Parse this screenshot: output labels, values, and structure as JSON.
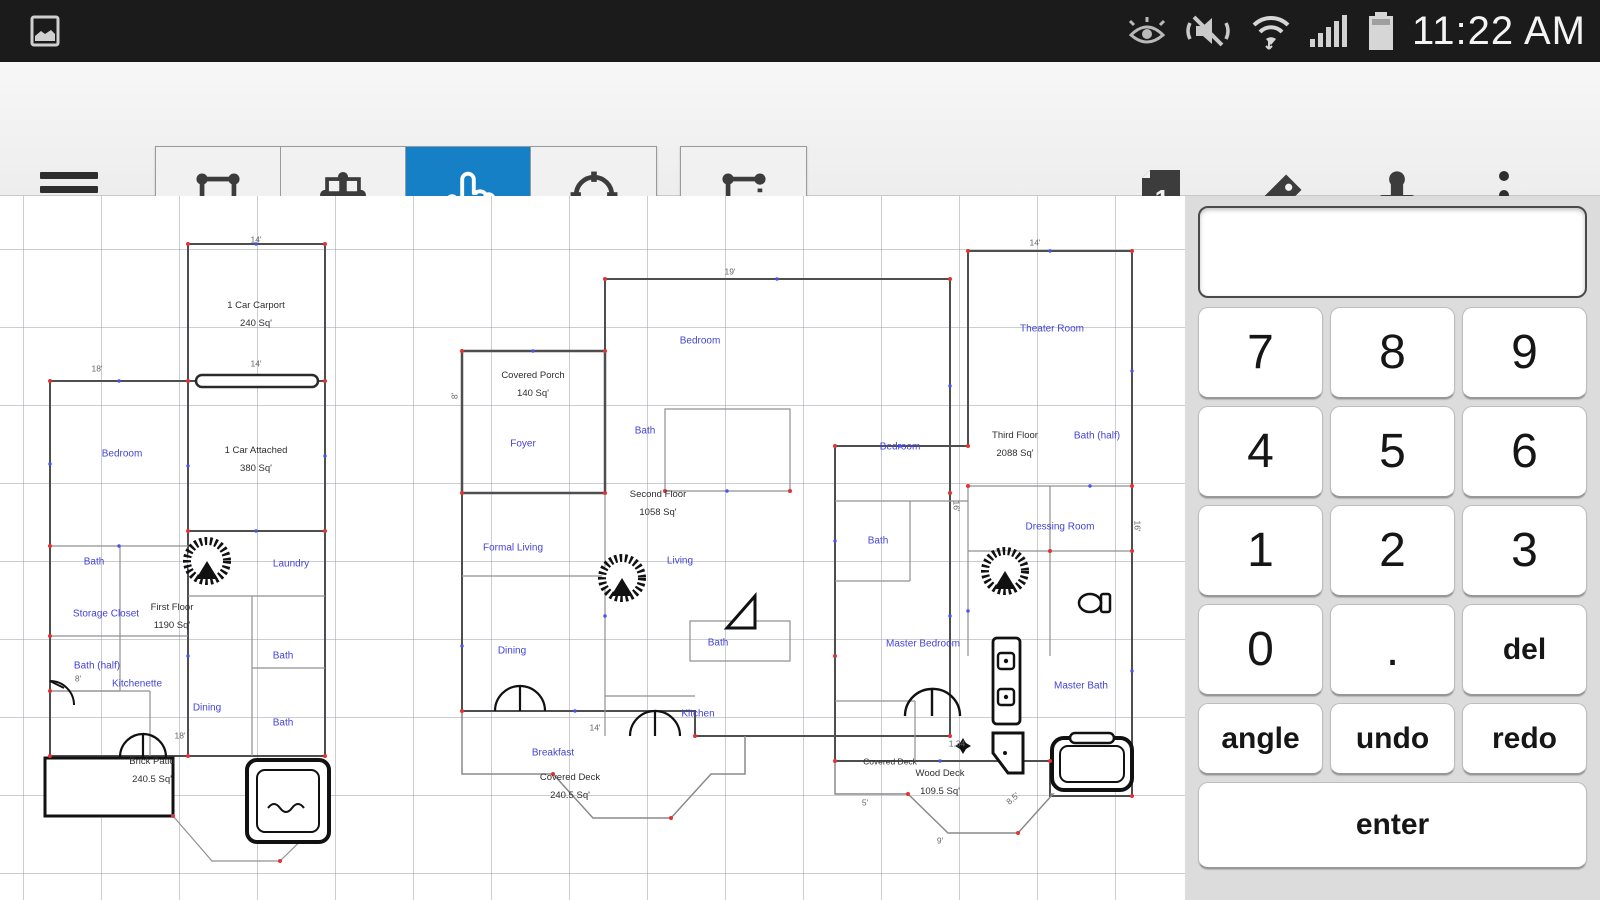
{
  "status_bar": {
    "time": "11:22 AM"
  },
  "toolbar": {
    "active_tool": "select-hand",
    "accent_color": "#1580c5",
    "page_badge": "1"
  },
  "keypad": {
    "display_value": "",
    "digits": [
      "7",
      "8",
      "9",
      "4",
      "5",
      "6",
      "1",
      "2",
      "3",
      "0",
      ".",
      "del"
    ],
    "actions": [
      "angle",
      "undo",
      "redo"
    ],
    "enter_label": "enter"
  },
  "plans": {
    "p1": {
      "rooms": [
        "Bedroom",
        "Bath",
        "Laundry",
        "Storage  Closet",
        "Bath",
        "Bath (half)",
        "Kitchenette",
        "Dining",
        "Bath"
      ],
      "areas": [
        "1 Car Carport",
        "240 Sq'",
        "1 Car Attached",
        "380 Sq'",
        "First Floor",
        "1190 Sq'",
        "Brick Patio",
        "240.5 Sq'"
      ],
      "dims": [
        "14'",
        "18'",
        "14'",
        "8'",
        "18'"
      ]
    },
    "p2": {
      "rooms": [
        "Bedroom",
        "Foyer",
        "Bath",
        "Formal Living",
        "Living",
        "Dining",
        "Bath",
        "Kitchen",
        "Breakfast"
      ],
      "areas": [
        "Covered Porch",
        "140 Sq'",
        "Second Floor",
        "1058 Sq'",
        "Covered Deck",
        "240.5 Sq'"
      ],
      "dims": [
        "19'",
        "8'",
        "16'",
        "14'"
      ]
    },
    "p3": {
      "rooms": [
        "Theater Room",
        "Bedroom",
        "Bath (half)",
        "Dressing  Room",
        "Bath",
        "Master Bedroom",
        "Master Bath"
      ],
      "areas": [
        "Third Floor",
        "2088 Sq'",
        "Covered Deck",
        "Wood Deck",
        "109.5 Sq'"
      ],
      "dims": [
        "14'",
        "16'",
        "1.34",
        "8.5'",
        "9'",
        "5'"
      ]
    }
  }
}
